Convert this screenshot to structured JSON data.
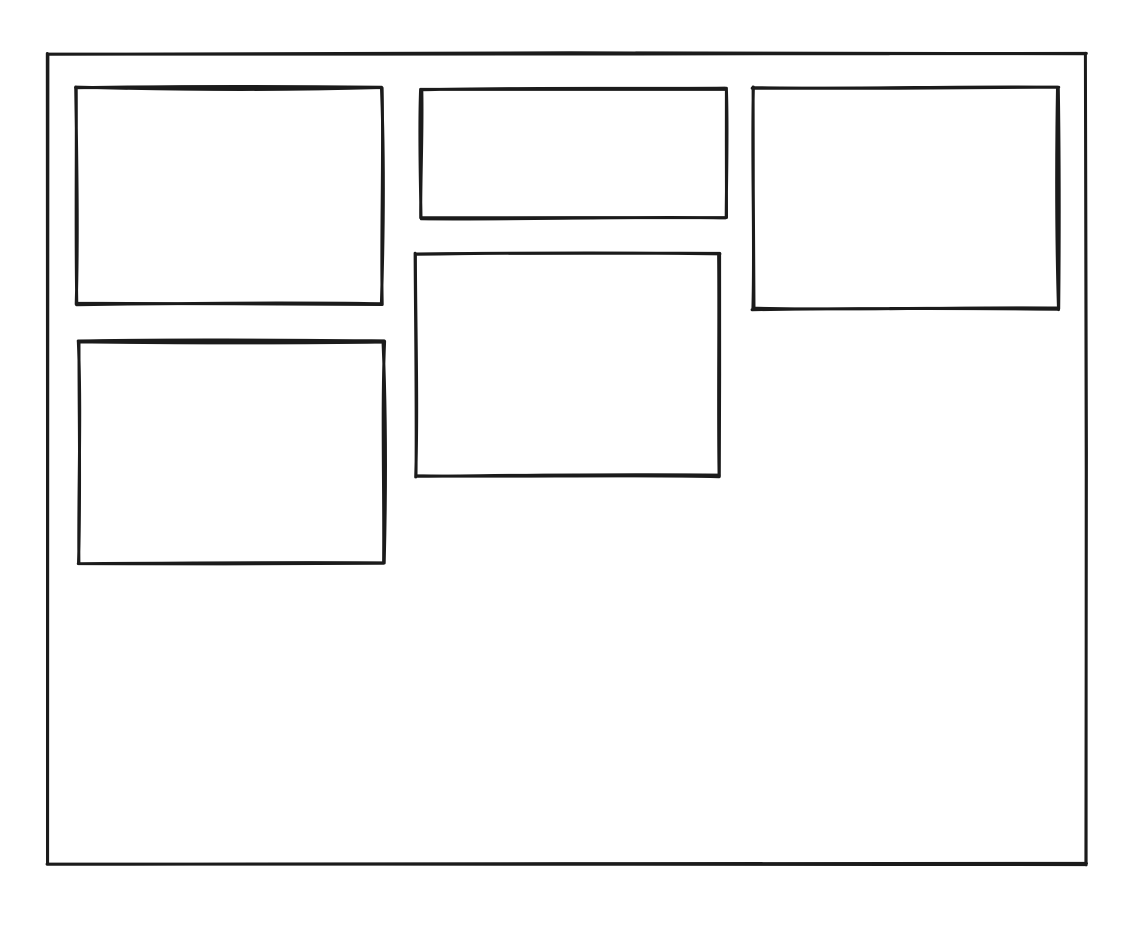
{
  "canvas": {
    "background": "#ffffff",
    "stroke_color": "#1b1b1b",
    "stroke_width": 3,
    "width": 1144,
    "height": 938,
    "style": "hand-drawn-sketch"
  },
  "wireframe": {
    "outer_frame": {
      "id": "outer-frame",
      "x": 48,
      "y": 54,
      "width": 1038,
      "height": 810
    },
    "boxes": [
      {
        "id": "box-top-left",
        "x": 76,
        "y": 88,
        "width": 306,
        "height": 216
      },
      {
        "id": "box-top-middle",
        "x": 421,
        "y": 89,
        "width": 305,
        "height": 129
      },
      {
        "id": "box-top-right",
        "x": 753,
        "y": 88,
        "width": 305,
        "height": 221
      },
      {
        "id": "box-center",
        "x": 416,
        "y": 254,
        "width": 303,
        "height": 222
      },
      {
        "id": "box-mid-left",
        "x": 79,
        "y": 341,
        "width": 305,
        "height": 222
      }
    ]
  }
}
